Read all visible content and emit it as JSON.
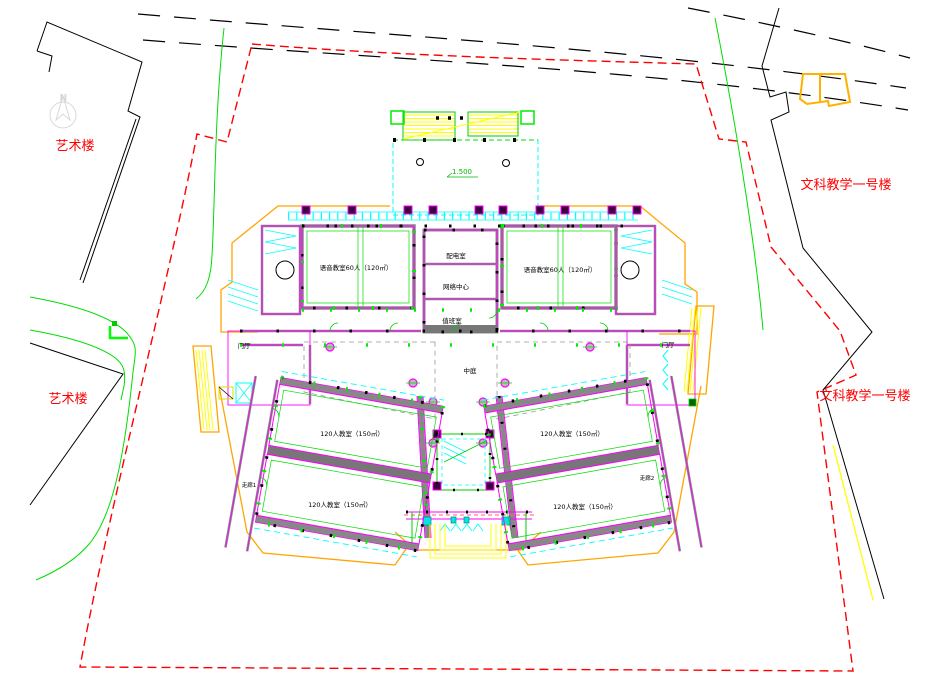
{
  "drawing": {
    "site_labels": {
      "art_building_upper": "艺术楼",
      "art_building_lower": "艺术楼",
      "liberal_arts_upper": "文科教学一号楼",
      "liberal_arts_lower": "文科教学一号楼"
    },
    "rooms": {
      "language_room_left": "语音教室60人（120㎡）",
      "language_room_right": "语音教室60人（120㎡）",
      "power_room": "配电室",
      "network_center": "网络中心",
      "duty_room": "值班室",
      "atrium": "中庭",
      "foyer_left": "门厅",
      "foyer_right": "门厅",
      "corridor_1": "走廊1",
      "corridor_2": "走廊2",
      "classroom_left_upper": "120人教室（150㎡）",
      "classroom_left_lower": "120人教室（150㎡）",
      "classroom_right_upper": "120人教室（150㎡）",
      "classroom_right_lower": "120人教室（150㎡）"
    },
    "markers": {
      "entry_platform_elevation": "1.500",
      "north": "N"
    },
    "palette": {
      "boundary_red": "#ff0000",
      "road_black": "#000000",
      "green_landscape": "#00dd00",
      "cad_cyan": "#00ffff",
      "cad_magenta": "#ff00ff",
      "cad_yellow": "#ffff00",
      "envelope_orange": "#ffa500",
      "wall_gray": "#808080",
      "label_red": "#ff0000"
    }
  }
}
